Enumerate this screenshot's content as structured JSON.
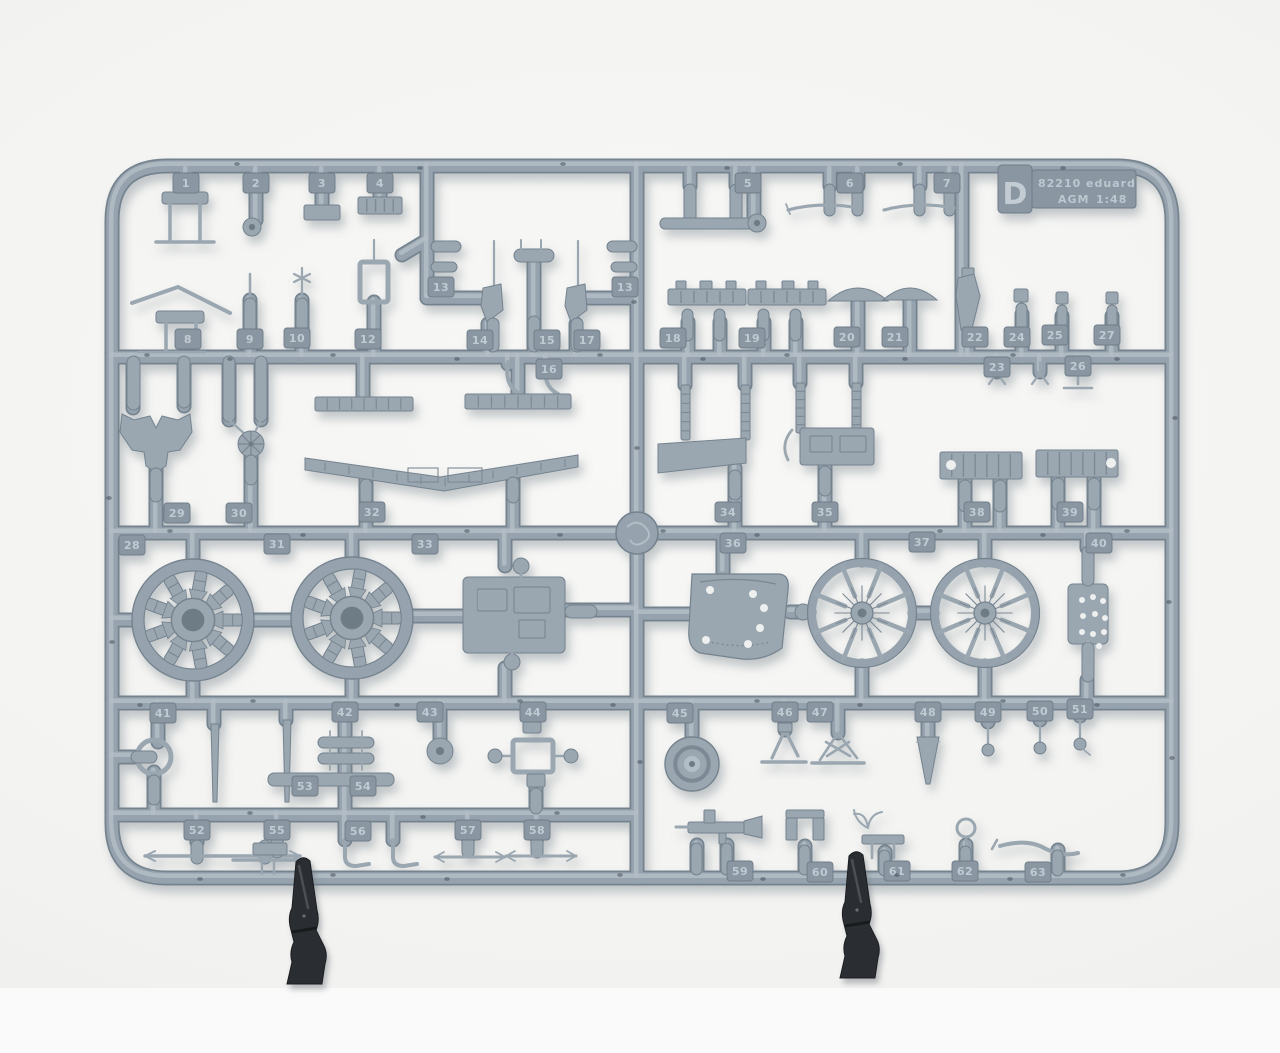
{
  "scene": {
    "description": "Grey injection-moulded plastic model kit sprue (frame D) photographed on a white background, supported by two black clamps",
    "object": "plastic-model-sprue"
  },
  "label": {
    "sprue_letter": "D",
    "kit_number": "82210",
    "brand": "eduard",
    "mold_code": "AGM",
    "scale": "1:48"
  },
  "colors": {
    "plastic_base": "#96a3ae",
    "plastic_dark": "#75838f",
    "plastic_light": "#b3bdc5",
    "part_fill": "#9aa6b0",
    "part_dark": "#7d8a95",
    "hole_light": "#eef0ef",
    "hole_dark": "#6e7b86",
    "tag_fill": "#8a97a2",
    "tag_text": "#c0cad2",
    "sink_dot": "#3e4953",
    "clamp": "#2a2d31",
    "clamp_highlight": "#55595e",
    "background": "#f3f3f1"
  },
  "part_tags": [
    {
      "n": "1",
      "x": 186,
      "y": 183
    },
    {
      "n": "2",
      "x": 256,
      "y": 183
    },
    {
      "n": "3",
      "x": 322,
      "y": 183
    },
    {
      "n": "4",
      "x": 380,
      "y": 183
    },
    {
      "n": "5",
      "x": 748,
      "y": 183
    },
    {
      "n": "6",
      "x": 850,
      "y": 183
    },
    {
      "n": "7",
      "x": 947,
      "y": 183
    },
    {
      "n": "13",
      "x": 441,
      "y": 287
    },
    {
      "n": "13",
      "x": 625,
      "y": 287
    },
    {
      "n": "8",
      "x": 188,
      "y": 339
    },
    {
      "n": "9",
      "x": 250,
      "y": 339
    },
    {
      "n": "10",
      "x": 297,
      "y": 338
    },
    {
      "n": "12",
      "x": 368,
      "y": 339
    },
    {
      "n": "14",
      "x": 480,
      "y": 340
    },
    {
      "n": "15",
      "x": 547,
      "y": 340
    },
    {
      "n": "17",
      "x": 587,
      "y": 340
    },
    {
      "n": "16",
      "x": 549,
      "y": 369
    },
    {
      "n": "18",
      "x": 673,
      "y": 338
    },
    {
      "n": "19",
      "x": 752,
      "y": 338
    },
    {
      "n": "20",
      "x": 847,
      "y": 337
    },
    {
      "n": "21",
      "x": 895,
      "y": 337
    },
    {
      "n": "22",
      "x": 975,
      "y": 337
    },
    {
      "n": "24",
      "x": 1017,
      "y": 337
    },
    {
      "n": "25",
      "x": 1055,
      "y": 335
    },
    {
      "n": "27",
      "x": 1107,
      "y": 335
    },
    {
      "n": "23",
      "x": 997,
      "y": 367
    },
    {
      "n": "26",
      "x": 1078,
      "y": 366
    },
    {
      "n": "29",
      "x": 177,
      "y": 513
    },
    {
      "n": "30",
      "x": 239,
      "y": 513
    },
    {
      "n": "32",
      "x": 372,
      "y": 512
    },
    {
      "n": "34",
      "x": 728,
      "y": 512
    },
    {
      "n": "35",
      "x": 825,
      "y": 512
    },
    {
      "n": "38",
      "x": 977,
      "y": 512
    },
    {
      "n": "39",
      "x": 1070,
      "y": 512
    },
    {
      "n": "28",
      "x": 132,
      "y": 545
    },
    {
      "n": "31",
      "x": 277,
      "y": 544
    },
    {
      "n": "33",
      "x": 425,
      "y": 544
    },
    {
      "n": "36",
      "x": 733,
      "y": 543
    },
    {
      "n": "37",
      "x": 922,
      "y": 542
    },
    {
      "n": "40",
      "x": 1099,
      "y": 543
    },
    {
      "n": "41",
      "x": 163,
      "y": 713
    },
    {
      "n": "42",
      "x": 345,
      "y": 712
    },
    {
      "n": "43",
      "x": 430,
      "y": 712
    },
    {
      "n": "44",
      "x": 533,
      "y": 712
    },
    {
      "n": "45",
      "x": 680,
      "y": 713
    },
    {
      "n": "46",
      "x": 785,
      "y": 712
    },
    {
      "n": "47",
      "x": 820,
      "y": 712
    },
    {
      "n": "48",
      "x": 928,
      "y": 712
    },
    {
      "n": "49",
      "x": 988,
      "y": 712
    },
    {
      "n": "50",
      "x": 1040,
      "y": 711
    },
    {
      "n": "51",
      "x": 1080,
      "y": 709
    },
    {
      "n": "53",
      "x": 305,
      "y": 786
    },
    {
      "n": "54",
      "x": 363,
      "y": 786
    },
    {
      "n": "52",
      "x": 197,
      "y": 830
    },
    {
      "n": "55",
      "x": 277,
      "y": 830
    },
    {
      "n": "56",
      "x": 358,
      "y": 831
    },
    {
      "n": "57",
      "x": 468,
      "y": 830
    },
    {
      "n": "58",
      "x": 537,
      "y": 830
    },
    {
      "n": "59",
      "x": 740,
      "y": 871
    },
    {
      "n": "60",
      "x": 820,
      "y": 872
    },
    {
      "n": "61",
      "x": 897,
      "y": 871
    },
    {
      "n": "62",
      "x": 965,
      "y": 871
    },
    {
      "n": "63",
      "x": 1038,
      "y": 872
    }
  ]
}
